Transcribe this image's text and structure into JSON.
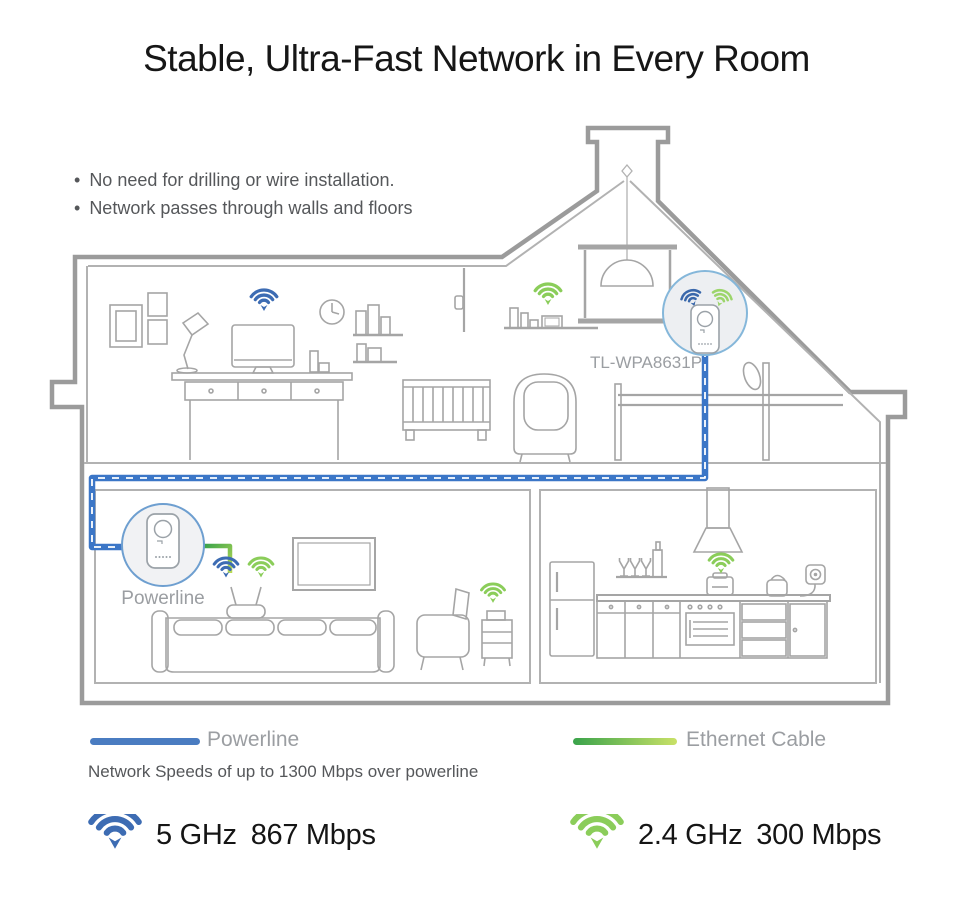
{
  "title": "Stable, Ultra-Fast Network in Every Room",
  "bullet_char": "•",
  "bullets": [
    "No need for drilling or wire installation.",
    "Network passes through walls and floors"
  ],
  "diagram": {
    "device_label": "TL-WPA8631P",
    "powerline_label": "Powerline"
  },
  "legend": {
    "powerline": {
      "label": "Powerline",
      "color": "#4a7cc1"
    },
    "ethernet": {
      "label": "Ethernet Cable",
      "color_start": "#3aa34b",
      "color_end": "#c9e167"
    },
    "caption": "Network Speeds of up to 1300 Mbps over powerline"
  },
  "speeds": [
    {
      "band": "5 GHz",
      "rate": "867 Mbps",
      "color": "#3d6cb3"
    },
    {
      "band": "2.4 GHz",
      "rate": "300 Mbps",
      "color": "#8bcd5a"
    }
  ],
  "colors": {
    "wifi_blue": "#3d6cb3",
    "wifi_green": "#8bcd5a",
    "powerline_cable": "#3b76c7",
    "house_outline": "#9b9b9b",
    "device_circle_border": "#7dabd6",
    "device_circle_fill": "#edeff2",
    "text_dark": "#151515",
    "text_gray": "#55575a",
    "label_gray": "#9b9ea2"
  }
}
